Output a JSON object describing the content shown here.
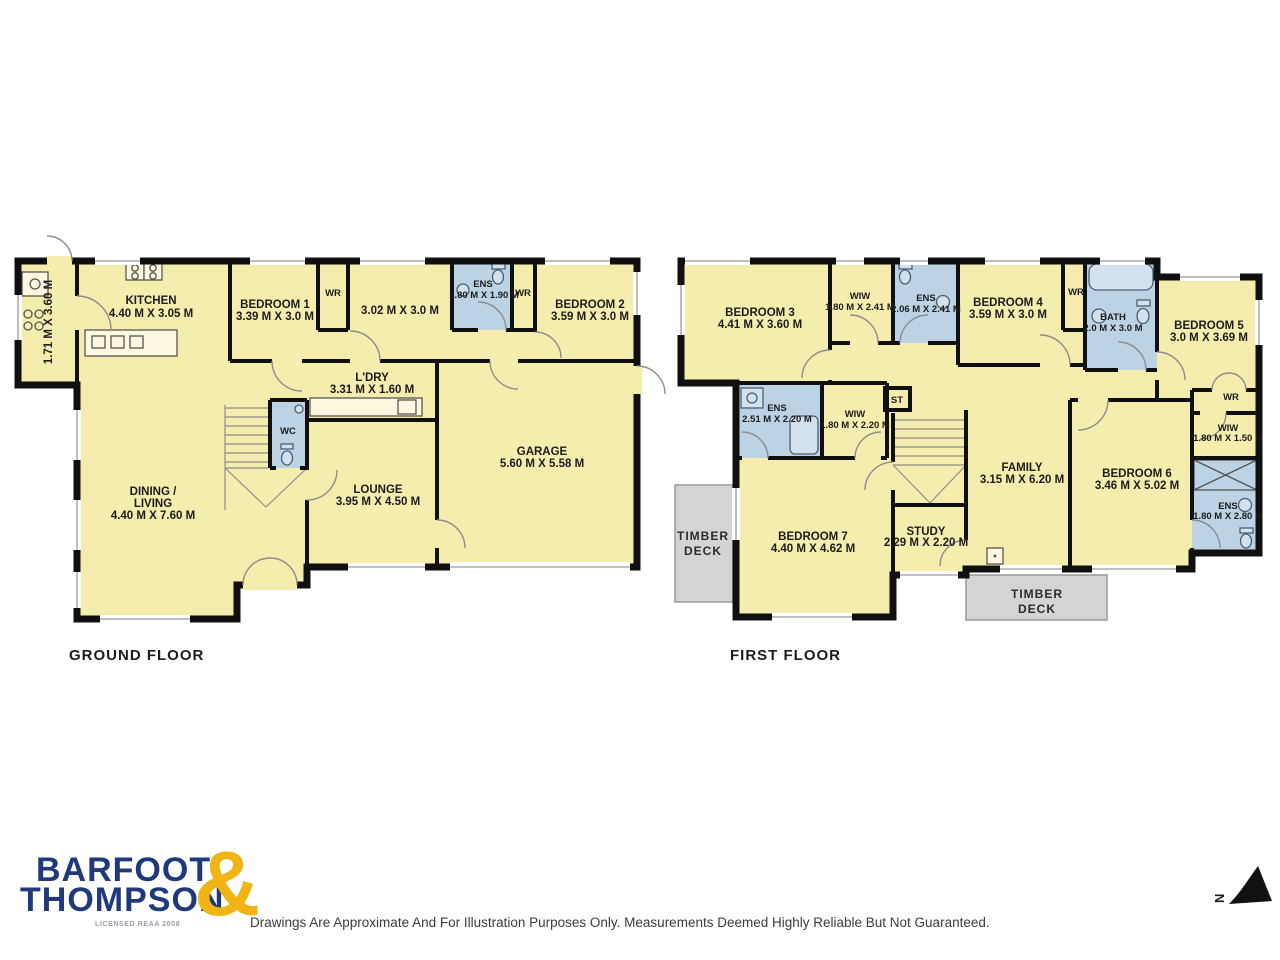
{
  "colors": {
    "room_fill": "#F5EDAD",
    "wet_room_fill": "#BCD2E5",
    "deck_fill": "#D4D4D6",
    "wall": "#101010",
    "brand_navy": "#20397A",
    "brand_gold": "#F0B414"
  },
  "ground": {
    "title": "GROUND FLOOR",
    "scullery_dims": "1.71 M X 3.60 M",
    "kitchen": {
      "name": "KITCHEN",
      "dims": "4.40 M X 3.05 M"
    },
    "bedroom1": {
      "name": "BEDROOM 1",
      "dims": "3.39 M X 3.0 M"
    },
    "wr1": "WR",
    "room302": {
      "dims": "3.02 M X 3.0 M"
    },
    "ens": {
      "name": "ENS",
      "dims": "1.80 M X 1.90 M"
    },
    "wr2": "WR",
    "bedroom2": {
      "name": "BEDROOM 2",
      "dims": "3.59 M X 3.0 M"
    },
    "ldry": {
      "name": "L'DRY",
      "dims": "3.31 M X 1.60 M"
    },
    "wc": "WC",
    "garage": {
      "name": "GARAGE",
      "dims": "5.60 M X 5.58 M"
    },
    "lounge": {
      "name": "LOUNGE",
      "dims": "3.95 M X 4.50 M"
    },
    "dining": {
      "name1": "DINING /",
      "name2": "LIVING",
      "dims": "4.40 M X 7.60 M"
    }
  },
  "first": {
    "title": "FIRST FLOOR",
    "bedroom3": {
      "name": "BEDROOM 3",
      "dims": "4.41 M X 3.60 M"
    },
    "wiw_a": {
      "name": "WIW",
      "dims": "1.80 M X 2.41 M"
    },
    "ens_a": {
      "name": "ENS",
      "dims": "2.06 M X 2.41 M"
    },
    "bedroom4": {
      "name": "BEDROOM 4",
      "dims": "3.59 M X 3.0 M"
    },
    "wr_a": "WR",
    "bath": {
      "name": "BATH",
      "dims": "2.0 M X 3.0 M"
    },
    "bedroom5": {
      "name": "BEDROOM 5",
      "dims": "3.0 M X 3.69 M"
    },
    "wr_b": "WR",
    "wiw_b": {
      "name": "WIW",
      "dims": "1.80 M X 1.50 M"
    },
    "ens_b": {
      "name": "ENS",
      "dims": "1.80 M X 2.80 M"
    },
    "bedroom6": {
      "name": "BEDROOM 6",
      "dims": "3.46 M X 5.02 M"
    },
    "family": {
      "name": "FAMILY",
      "dims": "3.15 M X 6.20 M"
    },
    "st": "ST",
    "ens_c": {
      "name": "ENS",
      "dims": "2.51 M X 2.20 M"
    },
    "wiw_c": {
      "name": "WIW",
      "dims": "1.80 M X 2.20 M"
    },
    "bedroom7": {
      "name": "BEDROOM 7",
      "dims": "4.40 M X 4.62 M"
    },
    "study": {
      "name": "STUDY",
      "dims": "2.29 M X 2.20 M"
    },
    "deck_left": {
      "line1": "TIMBER",
      "line2": "DECK"
    },
    "deck_bottom": {
      "line1": "TIMBER",
      "line2": "DECK"
    }
  },
  "footer": {
    "brand_line1": "BARFOOT",
    "brand_amp": "&",
    "brand_line2": "THOMPSON",
    "brand_licensed": "LICENSED REAA 2008",
    "disclaimer": "Drawings Are Approximate And For Illustration Purposes Only. Measurements Deemed Highly Reliable But Not Guaranteed.",
    "compass_n": "N"
  }
}
